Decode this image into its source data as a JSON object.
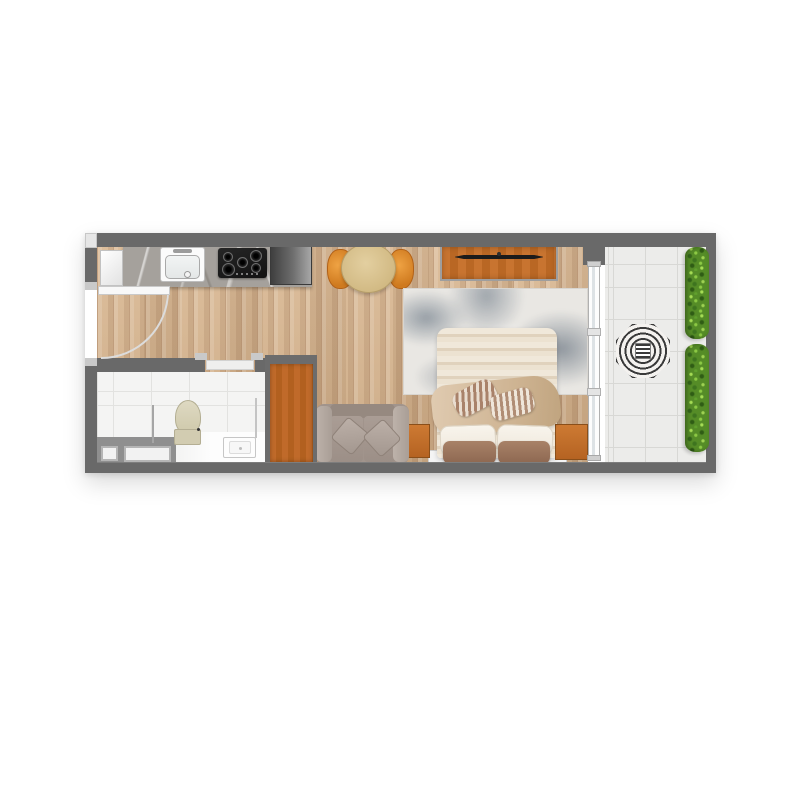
{
  "image_type": "apartment-floor-plan-top-view",
  "floorplan": {
    "rooms": [
      {
        "name": "kitchen",
        "features": [
          "marble-counter",
          "entry-cabinet",
          "kitchen-sink",
          "gas-hob",
          "refrigerator"
        ]
      },
      {
        "name": "entry",
        "features": [
          "entry-door-leaf",
          "entry-door-swing-arc"
        ]
      },
      {
        "name": "bathroom",
        "features": [
          "toilet",
          "vanity-sink",
          "shower-screen-left",
          "shower-screen-right",
          "utility-ledge",
          "utility-niche-1",
          "utility-niche-2",
          "bathroom-sliding-door"
        ]
      },
      {
        "name": "living-bedroom",
        "features": [
          "dining-table",
          "dining-chair-left",
          "dining-chair-right",
          "tv-console",
          "tv",
          "area-rug",
          "double-bed",
          "bed-blanket",
          "bed-bolsters",
          "bed-pillows",
          "nightstand-left",
          "nightstand-right",
          "sofa",
          "wardrobe"
        ]
      },
      {
        "name": "balcony",
        "features": [
          "sliding-glass-window",
          "parasol-table",
          "hedge-planter-top",
          "hedge-planter-bottom"
        ]
      }
    ],
    "palette": {
      "wall": "#696969",
      "wood_floor": "#d9b791",
      "marble_counter": "#a5a19c",
      "orange_wood": "#c06a2a",
      "chair_orange": "#e0892f",
      "table_wood": "#d8c28f",
      "bathroom_tile": "#f4f4f3",
      "balcony_tile": "#ececea",
      "hedge_green": "#5d9630",
      "rug_gray": "#8a939c",
      "bed_cream": "#ece2d1",
      "pillow_brown": "#9c7860",
      "sofa_taupe": "#a1948c",
      "parasol_stripe": "#3a3a3a",
      "appliance_black": "#1d1d1d",
      "fridge_gray": "#6e6e6e",
      "glass_frame_white": "#fdfdfd"
    }
  }
}
